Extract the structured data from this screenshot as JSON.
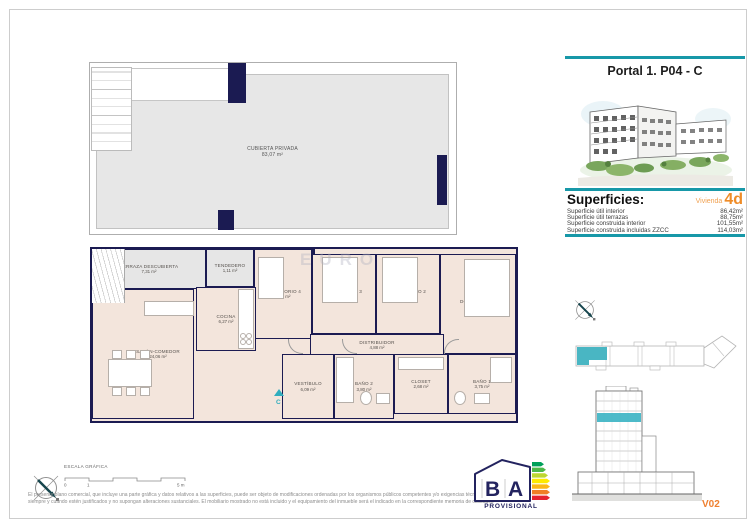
{
  "header": {
    "portal_title": "Portal 1. P04 - C"
  },
  "superficies": {
    "heading": "Superficies:",
    "vivienda_label": "Vivienda",
    "vivienda_code": "4d",
    "rows": [
      {
        "label": "Superficie útil interior",
        "value": "86,42m²"
      },
      {
        "label": "Superficie útil terrazas",
        "value": "88,75m²"
      },
      {
        "label": "Superficie construida interior",
        "value": "101,55m²"
      },
      {
        "label": "Superficie construida incluidas ZZCC",
        "value": "114,03m²"
      }
    ]
  },
  "roof_plan": {
    "name": "CUBIERTA PRIVADA",
    "area": "83,07 m²"
  },
  "floor_plan": {
    "watermark": "EURO",
    "entrance_letter": "C",
    "rooms": [
      {
        "name": "TERRAZA DESCUBIERTA",
        "area": "7,31 m²"
      },
      {
        "name": "TENDEDERO",
        "area": "1,11 m²"
      },
      {
        "name": "COCINA",
        "area": "6,27 m²"
      },
      {
        "name": "SALÓN-COMEDOR",
        "area": "24,06 m²"
      },
      {
        "name": "DORMITORIO 4",
        "area": "7,48 m²"
      },
      {
        "name": "DORMITORIO 3",
        "area": "8,06 m²"
      },
      {
        "name": "DORMITORIO 2",
        "area": "5,78 m²"
      },
      {
        "name": "DORMITORIO 1",
        "area": "11,68 m²"
      },
      {
        "name": "DISTRIBUIDOR",
        "area": "4,88 m²"
      },
      {
        "name": "VESTÍBULO",
        "area": "6,09 m²"
      },
      {
        "name": "BAÑO 2",
        "area": "3,80 m²"
      },
      {
        "name": "CLOSET",
        "area": "2,68 m²"
      },
      {
        "name": "BAÑO 1",
        "area": "3,75 m²"
      }
    ]
  },
  "elevation": {
    "version": "V02"
  },
  "energy_label": {
    "letter_b": "B",
    "letter_a": "A",
    "caption": "PROVISIONAL"
  },
  "scale_bar": {
    "label": "ESCALA GRÁFICA",
    "tick_start": "0",
    "tick_one": "1",
    "tick_end": "5 m"
  },
  "disclaimer": {
    "line1": "El presente plano comercial, que incluye una parte gráfica y datos relativos a las superficies, puede ser objeto de modificaciones ordenadas por los organismos públicos competentes y/o exigencias técnicas o jurídicas,",
    "line2": "siempre y cuando estén justificados y no supongan alteraciones sustanciales. El mobiliario mostrado no está incluido y el equipamiento del inmueble será el indicado en la correspondiente memoria de calidades"
  },
  "colors": {
    "accent_teal": "#1798a8",
    "accent_orange": "#ef8c28",
    "wall_navy": "#1b1b52"
  }
}
